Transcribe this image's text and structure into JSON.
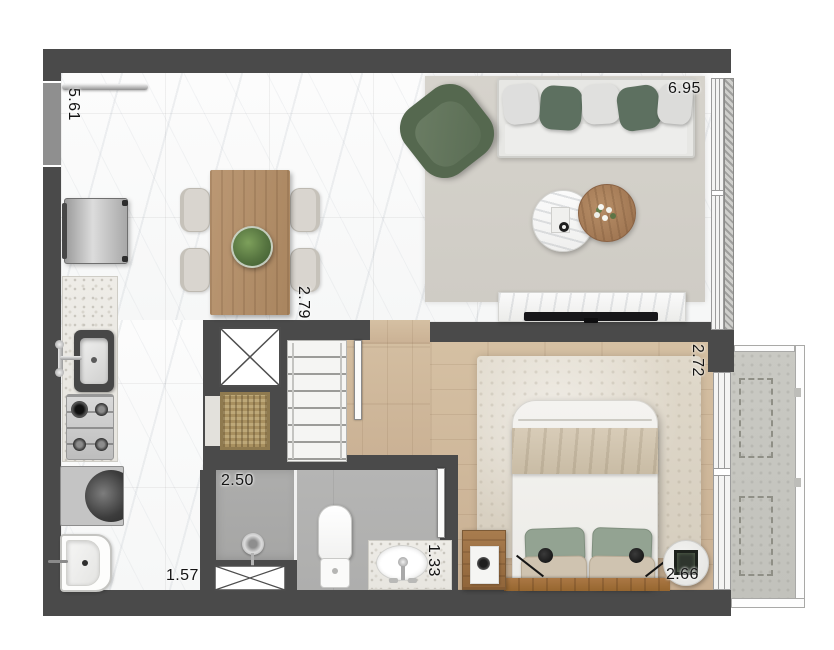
{
  "floorplan": {
    "title": "studio-apartment-floor-plan",
    "dimensions": {
      "left_vertical": "5.61",
      "top_right_width": "6.95",
      "hall_vertical": "2.79",
      "bedroom_right_vertical": "2.72",
      "shower_width": "2.50",
      "kitchen_bottom_width": "1.57",
      "vanity_vertical": "1.33",
      "bedroom_bottom_width": "2.66"
    },
    "colors": {
      "wall": "#4a4a4a",
      "accent_green": "#5d7060",
      "sage_pillow": "#93a392",
      "wood_floor": "#cdb69b",
      "wood_table": "#b3906c",
      "marble_floor": "#f7f8f8",
      "living_rug": "#d3d0c9",
      "bedroom_rug": "#dcd4c6",
      "bathroom_floor": "#b2b2b1",
      "balcony_floor": "#c6c6c0"
    },
    "icons": [
      "sofa",
      "armchair",
      "marble-coffee-table",
      "wood-coffee-table",
      "dining-table",
      "dining-chair",
      "plant",
      "fridge",
      "kitchen-sink",
      "cooktop",
      "washer",
      "laundry-tub",
      "duct-shaft",
      "basket",
      "wardrobe",
      "shower-drain",
      "toilet",
      "vanity-sink",
      "bed",
      "nightstand",
      "reading-lamp",
      "tv-console",
      "balcony-planter",
      "window",
      "sliding-door",
      "door-leaf"
    ]
  }
}
